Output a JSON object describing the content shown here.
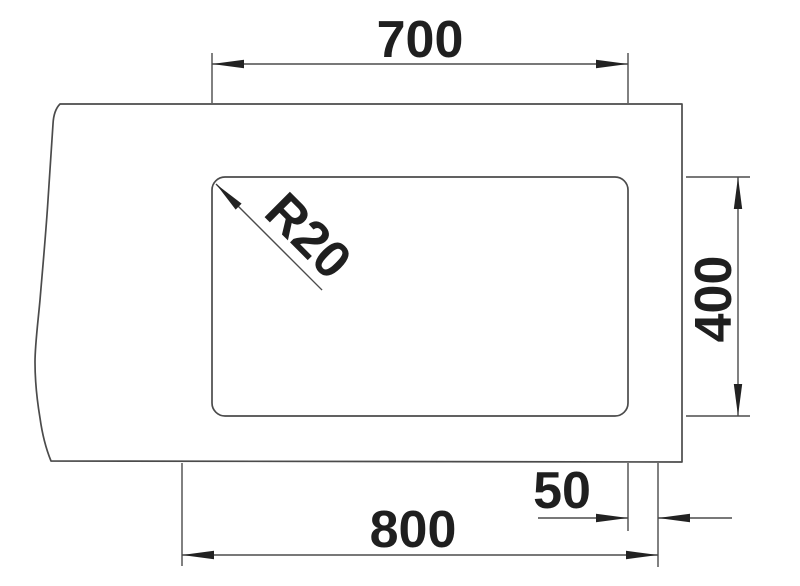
{
  "diagram": {
    "kind": "technical-dimension-drawing",
    "dimensions": [
      {
        "id": "cutout-width",
        "label": "700"
      },
      {
        "id": "cutout-height",
        "label": "400"
      },
      {
        "id": "overall-width",
        "label": "800"
      },
      {
        "id": "edge-offset",
        "label": "50"
      },
      {
        "id": "corner-radius",
        "label": "R20"
      }
    ],
    "colors": {
      "background": "#ffffff",
      "line": "#4b4b4b",
      "ink": "#1f1f1f"
    }
  }
}
